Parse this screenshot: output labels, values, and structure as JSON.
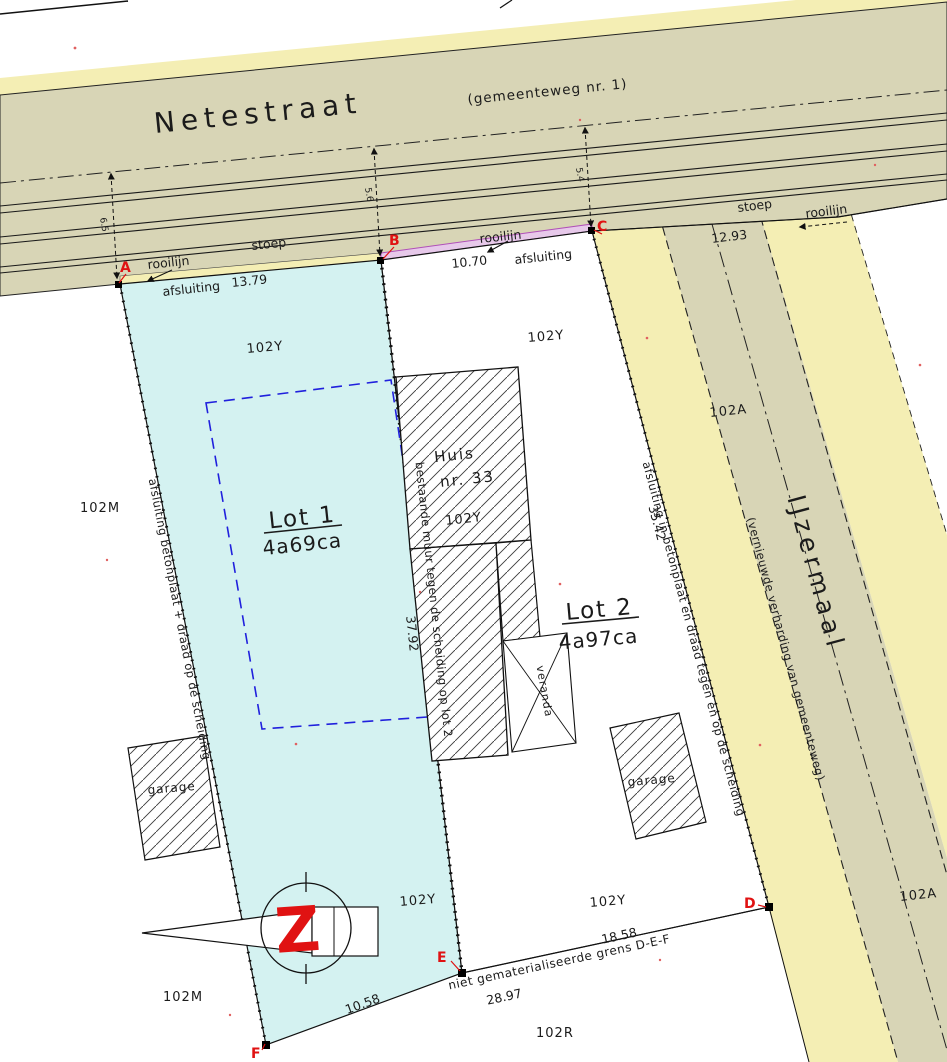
{
  "street": {
    "name": "Netestraat",
    "subtitle": "(gemeenteweg nr. 1)",
    "stoep_left": "stoep",
    "stoep_right": "stoep",
    "rooilijn_left": "rooilijn",
    "rooilijn_mid": "rooilijn",
    "rooilijn_right": "rooilijn",
    "afsluiting_left": "afsluiting",
    "afsluiting_mid": "afsluiting",
    "dim_ab": "13.79",
    "dim_bc": "10.70",
    "dim_right": "12.93",
    "offset_a": "6.5",
    "offset_b": "5.6",
    "offset_c": "5.4"
  },
  "road2": {
    "name": "IJzermaal",
    "subtitle": "(vernieuwde verharding van gemeenteweg)"
  },
  "lots": {
    "lot1_name": "Lot 1",
    "lot1_area": "4a69ca",
    "lot2_name": "Lot 2",
    "lot2_area": "4a97ca"
  },
  "house": {
    "line1": "Huis",
    "line2": "nr. 33",
    "parcel": "102Y"
  },
  "buildings": {
    "garage_left": "garage",
    "garage_right": "garage",
    "veranda": "veranda"
  },
  "boundaries": {
    "left": "afsluiting betonplaat + draad op de scheiding",
    "middle": "bestaande muur tegen de scheiding op lot 2",
    "right": "afsluiting in betonplaat en draad tegen en op de scheiding",
    "dim_middle": "37.92",
    "dim_right": "35.42"
  },
  "bottom": {
    "grens": "niet gematerialiseerde grens D-E-F",
    "dim_fe": "10.58",
    "dim_ed": "28.97",
    "dim_d": "18.58"
  },
  "parcels": {
    "y_lot1_top": "102Y",
    "y_lot2_top": "102Y",
    "y_lot1_bottom": "102Y",
    "y_lot2_bottom": "102Y",
    "m_left": "102M",
    "m_bottom": "102M",
    "a_top": "102A",
    "a_bottom": "102A",
    "r_bottom": "102R"
  },
  "points": {
    "a": "A",
    "b": "B",
    "c": "C",
    "d": "D",
    "e": "E",
    "f": "F"
  },
  "north": {
    "letter": "Z"
  },
  "colors": {
    "street_fill": "#d8d5b6",
    "verge_fill": "#f4eeb4",
    "lot1_fill": "#d4f2f1",
    "envelope_stroke": "#2020dd",
    "marker_red": "#e01212",
    "rooilijn_bc": "#b050b8"
  }
}
